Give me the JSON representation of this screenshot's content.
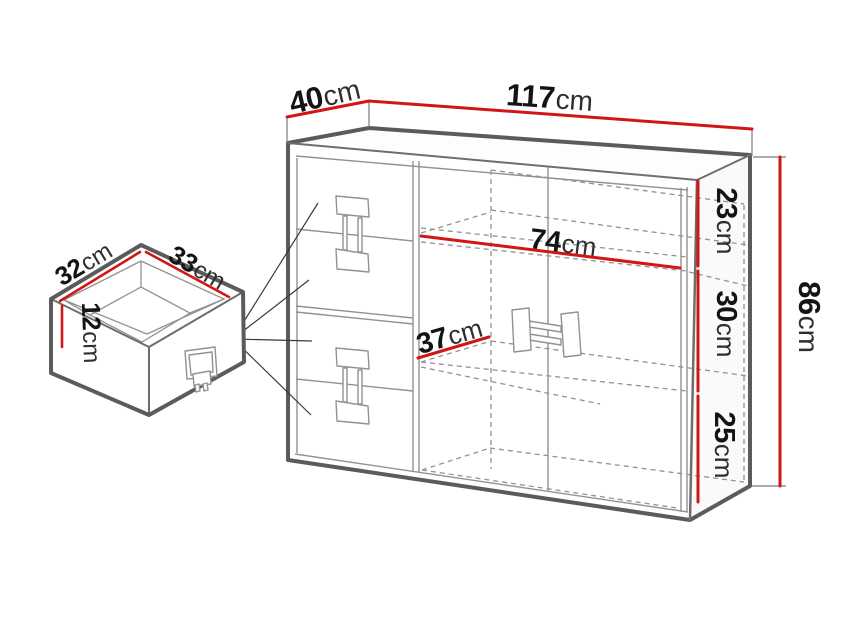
{
  "diagram": {
    "cabinet": {
      "width": {
        "value": "117",
        "unit": "cm"
      },
      "depth": {
        "value": "40",
        "unit": "cm"
      },
      "height": {
        "value": "86",
        "unit": "cm"
      },
      "top_section_height": {
        "value": "23",
        "unit": "cm"
      },
      "middle_section_height": {
        "value": "30",
        "unit": "cm"
      },
      "bottom_section_height": {
        "value": "25",
        "unit": "cm"
      },
      "interior_width": {
        "value": "74",
        "unit": "cm"
      },
      "interior_depth": {
        "value": "37",
        "unit": "cm"
      }
    },
    "drawer": {
      "depth": {
        "value": "32",
        "unit": "cm"
      },
      "width": {
        "value": "33",
        "unit": "cm"
      },
      "height": {
        "value": "12",
        "unit": "cm"
      }
    },
    "colors": {
      "dimension_line": "#d21616",
      "outline": "#5b5b5b",
      "mid_line": "#6e6e6e",
      "thin_line": "#929292",
      "leader_line": "#3a3a3a",
      "text": "#141414"
    }
  }
}
